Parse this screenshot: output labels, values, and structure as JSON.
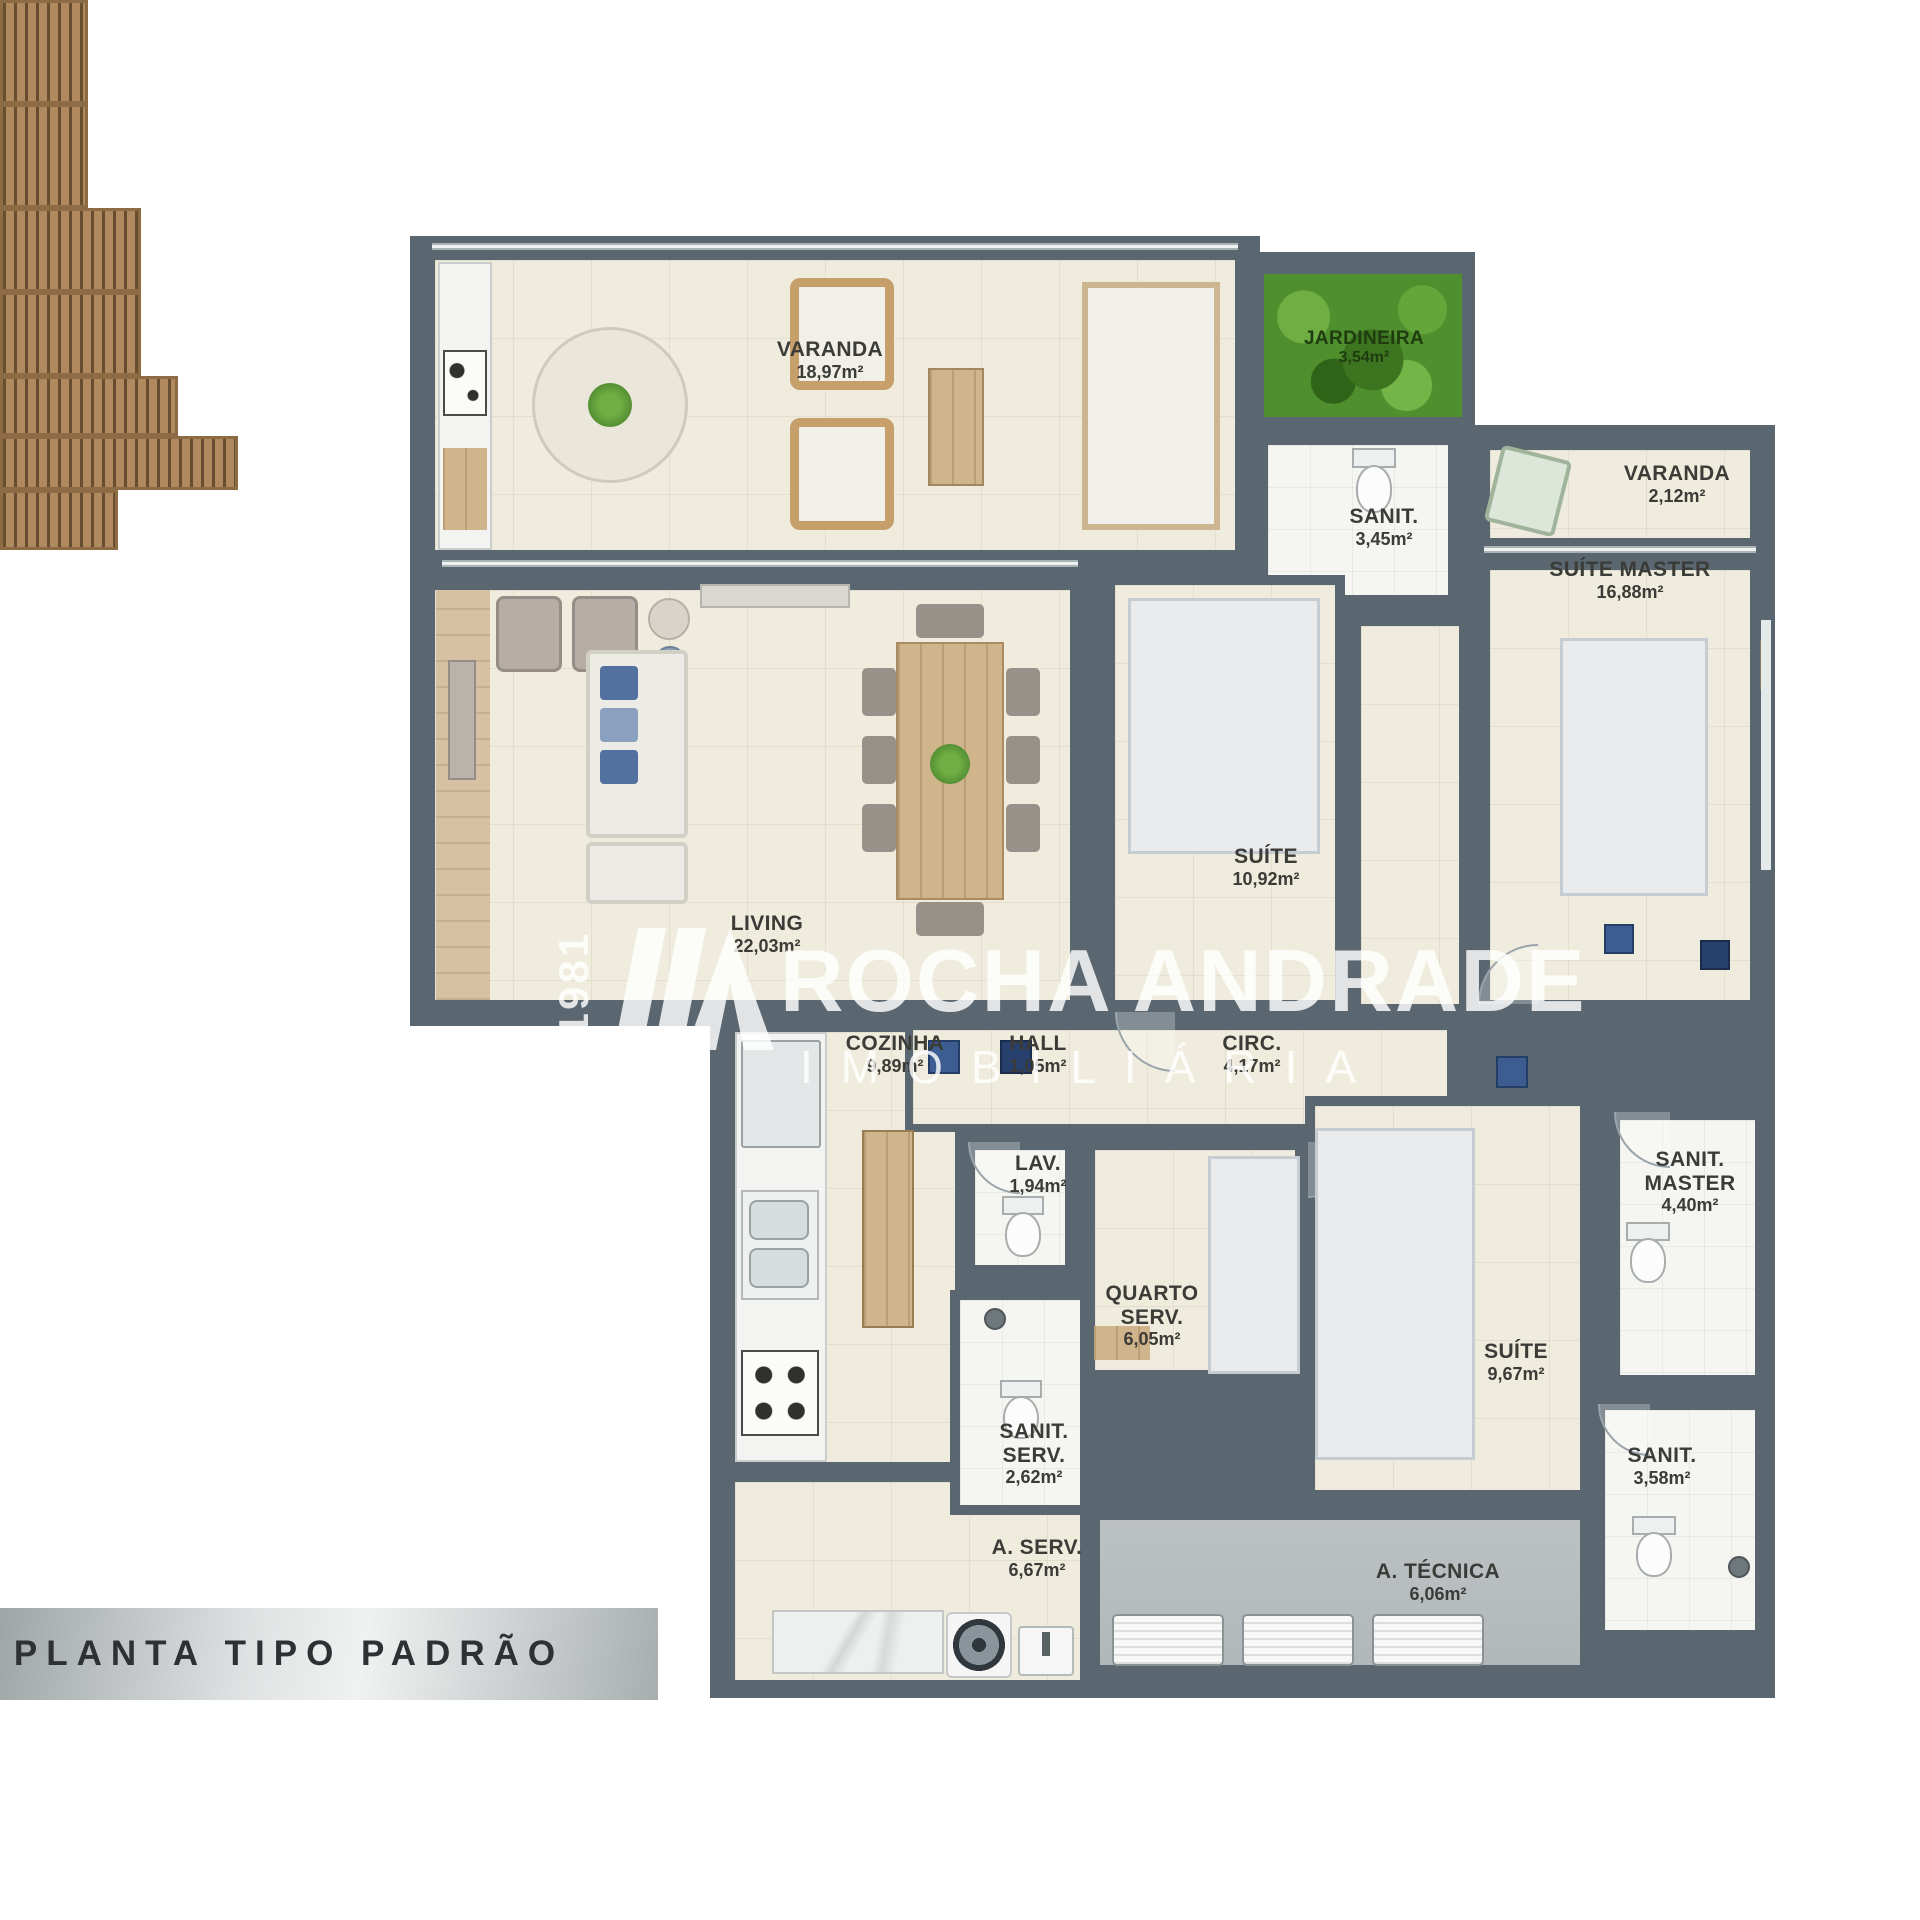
{
  "banner": {
    "label": "PLANTA TIPO PADRÃO"
  },
  "watermark": {
    "brand_top": "ROCHA ANDRADE",
    "brand_bottom": "IMOBILIÁRIA",
    "vertical_code": "J31981"
  },
  "rooms": [
    {
      "id": "varanda_gourmet",
      "name": "VARANDA",
      "area": "18,97m²"
    },
    {
      "id": "jardineira",
      "name": "JARDINEIRA",
      "area": "3,54m²"
    },
    {
      "id": "sanit_suite",
      "name": "SANIT.",
      "area": "3,45m²"
    },
    {
      "id": "varanda_master",
      "name": "VARANDA",
      "area": "2,12m²"
    },
    {
      "id": "suite_master",
      "name": "SUÍTE MASTER",
      "area": "16,88m²"
    },
    {
      "id": "suite_2",
      "name": "SUÍTE",
      "area": "10,92m²"
    },
    {
      "id": "living",
      "name": "LIVING",
      "area": "22,03m²"
    },
    {
      "id": "cozinha",
      "name": "COZINHA",
      "area": "9,89m²"
    },
    {
      "id": "hall",
      "name": "HALL",
      "area": "1,05m²"
    },
    {
      "id": "circ",
      "name": "CIRC.",
      "area": "4,17m²"
    },
    {
      "id": "lav",
      "name": "LAV.",
      "area": "1,94m²"
    },
    {
      "id": "quarto_serv",
      "name": "QUARTO SERV.",
      "area": "6,05m²"
    },
    {
      "id": "suite_3",
      "name": "SUÍTE",
      "area": "9,67m²"
    },
    {
      "id": "sanit_master",
      "name": "SANIT. MASTER",
      "area": "4,40m²"
    },
    {
      "id": "sanit_serv",
      "name": "SANIT. SERV.",
      "area": "2,62m²"
    },
    {
      "id": "sanit_3",
      "name": "SANIT.",
      "area": "3,58m²"
    },
    {
      "id": "area_serv",
      "name": "A. SERV.",
      "area": "6,67m²"
    },
    {
      "id": "area_tecnica",
      "name": "A. TÉCNICA",
      "area": "6,06m²"
    }
  ],
  "colors": {
    "wall": "#5a6770",
    "floor_cream": "#efecdd",
    "floor_bath": "#f5f5f1",
    "floor_gray": "#b9bec0",
    "garden_green": "#4f8f2d",
    "wood": "#b08a5e",
    "accent_blue": "#4f6da3",
    "banner_text": "#2d3133"
  }
}
